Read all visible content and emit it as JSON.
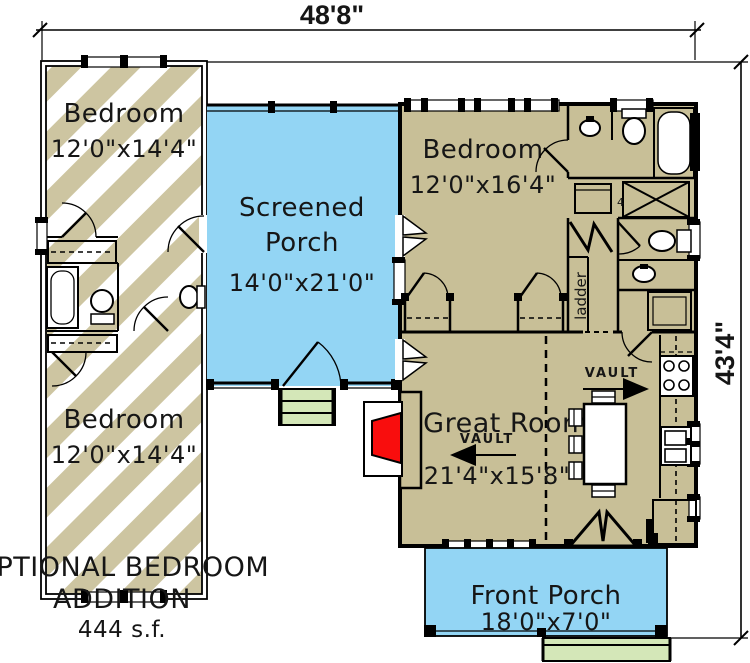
{
  "colors": {
    "tan": "#c8bf97",
    "blue": "#93d5f4",
    "green": "#d4e7b8",
    "red": "#f90d0d"
  },
  "dimensions": {
    "width_top": "48'8\"",
    "height_right": "43'4\""
  },
  "rooms": {
    "addition_bedroom_top": {
      "name": "Bedroom",
      "size": "12'0\"x14'4\""
    },
    "addition_bedroom_bottom": {
      "name": "Bedroom",
      "size": "12'0\"x14'4\""
    },
    "screened_porch": {
      "name_line1": "Screened",
      "name_line2": "Porch",
      "size": "14'0\"x21'0\""
    },
    "main_bedroom": {
      "name": "Bedroom",
      "size": "12'0\"x16'4\""
    },
    "great_room": {
      "name": "Great Room",
      "size": "21'4\"x15'8\""
    },
    "front_porch": {
      "name": "Front Porch",
      "size": "18'0\"x7'0\""
    }
  },
  "labels": {
    "vault_left": "VAULT",
    "vault_right": "VAULT",
    "ladder": "ladder",
    "closet_mark": "4"
  },
  "caption": {
    "line1": "OPTIONAL BEDROOM",
    "line2": "ADDITION",
    "line3": "444  s.f."
  }
}
